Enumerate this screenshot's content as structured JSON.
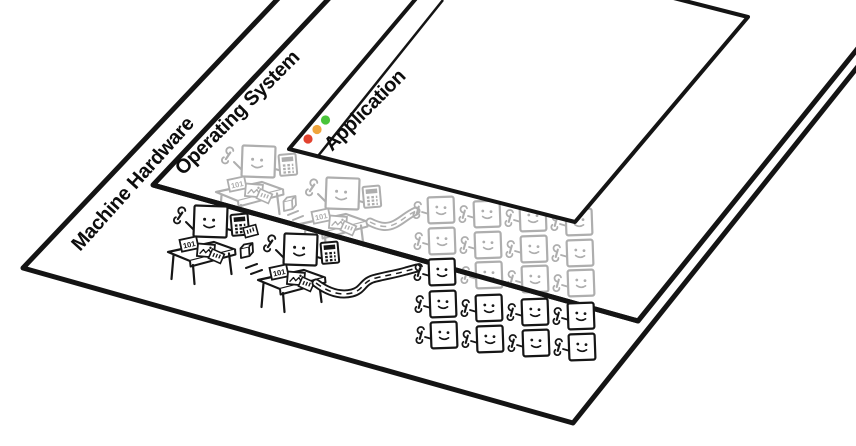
{
  "diagram": {
    "title": "Application / Operating System / Machine Hardware layer illustration",
    "layers": [
      {
        "id": "machine-hardware",
        "label": "Machine Hardware",
        "depth": 0
      },
      {
        "id": "operating-system",
        "label": "Operating System",
        "depth": 1
      },
      {
        "id": "application",
        "label": "Application",
        "depth": 2
      }
    ]
  },
  "app_window": {
    "traffic_lights": [
      {
        "name": "close-light",
        "color": "#e2422e"
      },
      {
        "name": "minimize-light",
        "color": "#f0a53c"
      },
      {
        "name": "zoom-light",
        "color": "#49c43a"
      }
    ]
  },
  "artwork": {
    "binary_card_text": "101",
    "ink_color": "#161616",
    "faded_color": "#aeaeae",
    "os_worker_count": 11,
    "hw_worker_count": 9,
    "desk_scene_count": 4
  }
}
